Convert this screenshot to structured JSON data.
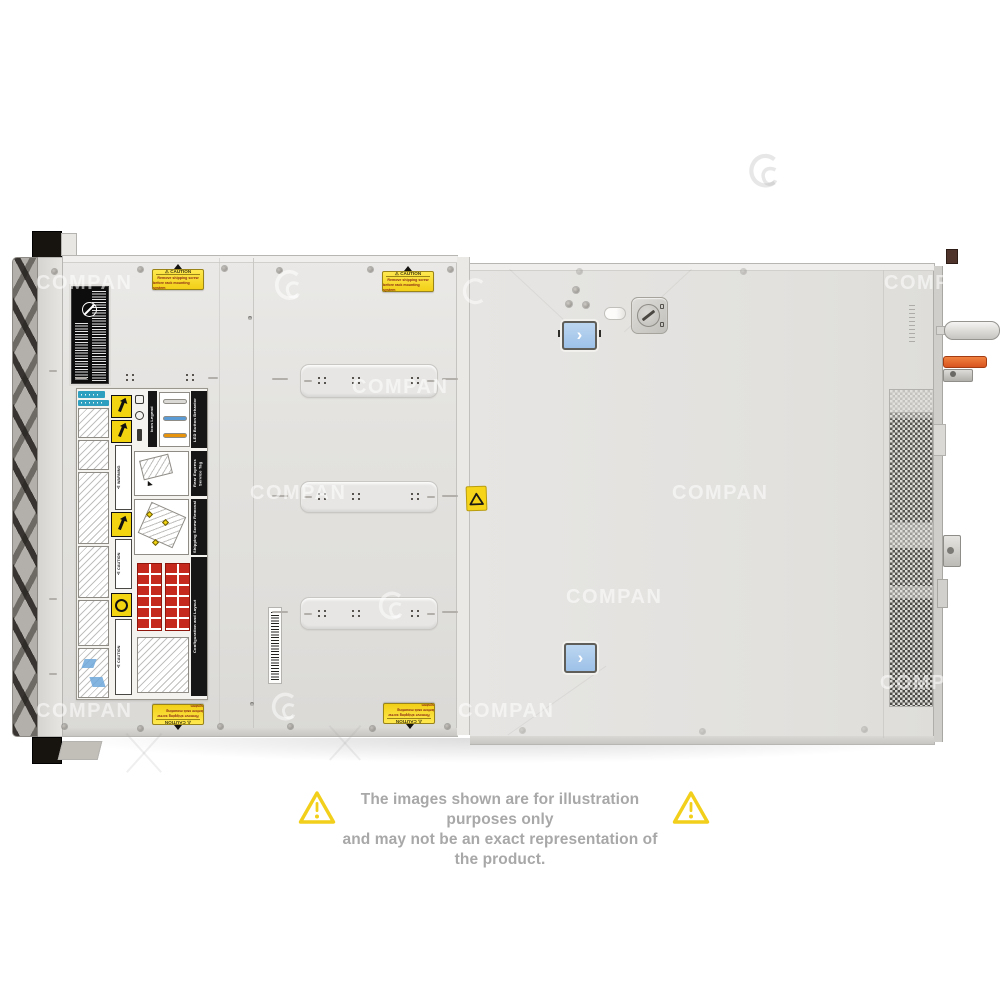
{
  "watermark": {
    "text": "COMPAN",
    "logo_icon": "swirl-logo"
  },
  "server": {
    "shipping_sticker": {
      "title": "⚠ CAUTION",
      "line1": "Remove shipping screw",
      "line2": "before rack mounting system"
    },
    "service_label": {
      "sections": [
        "LED Button Behavior",
        "Icon Legend",
        "Rear Express Service Tag",
        "Shipping Screw Removal",
        "Configuration and Layout"
      ],
      "warning_strip": "⚠ WARNING",
      "caution_strip": "⚠ CAUTION"
    },
    "latch_chevron": "›"
  },
  "disclaimer": {
    "line1": "The images shown are for illustration purposes only",
    "line2": "and may not be an exact representation of the product."
  },
  "colors": {
    "caution_yellow": "#f2cf17",
    "latch_blue": "#a9c9ec",
    "led_blue": "#5b9bd5",
    "led_amber": "#e8930c",
    "config_red": "#c5281c",
    "lever_orange": "#e0662b",
    "disclaimer_gray": "#a8a8a8",
    "triangle_yellow": "#f2cf1b"
  }
}
